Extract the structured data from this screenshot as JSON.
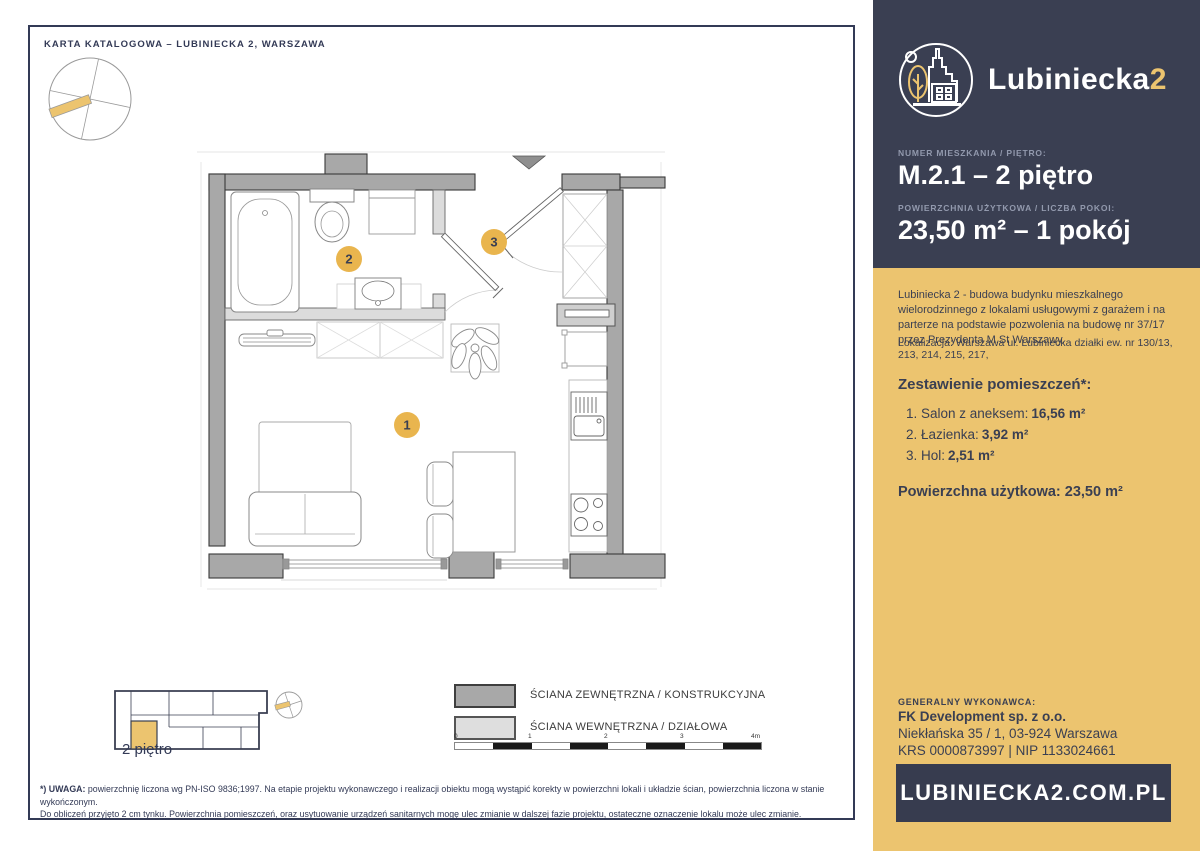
{
  "colors": {
    "navy": "#3a3f52",
    "panel_yellow": "#ecc46f",
    "badge_yellow": "#e9b54e",
    "wall_dark": "#a8a8a8",
    "wall_light": "#dcdcdc"
  },
  "card": {
    "header": "KARTA KATALOGOWA – LUBINIECKA 2, WARSZAWA",
    "mini_plan_label": "2 piętro",
    "plan_badges": {
      "salon": "1",
      "bathroom": "2",
      "hall": "3"
    },
    "legend": [
      {
        "label": "ŚCIANA ZEWNĘTRZNA / KONSTRUKCYJNA"
      },
      {
        "label": "ŚCIANA WEWNĘTRZNA / DZIAŁOWA"
      }
    ],
    "scale_ticks": [
      "0",
      "1",
      "2",
      "3",
      "4m"
    ],
    "footnote_label": "*) UWAGA:",
    "footnote_line1": "powierzchnię liczona wg PN-ISO 9836;1997. Na etapie projektu wykonawczego i realizacji obiektu mogą wystąpić korekty w powierzchni lokali i układzie ścian, powierzchnia liczona w stanie wykończonym.",
    "footnote_line2": "Do obliczeń przyjęto 2 cm tynku. Powierzchnia pomieszczeń, oraz usytuowanie urządzeń sanitarnych mogę ulec zmianie w dalszej fazie projektu, ostateczne oznaczenie lokalu może ulec zmianie."
  },
  "sidebar": {
    "logo_text": "Lubiniecka",
    "logo_accent": "2",
    "unit_label": "NUMER MIESZKANIA / PIĘTRO:",
    "unit_value": "M.2.1 – 2 piętro",
    "area_label": "POWIERZCHNIA UŻYTKOWA / LICZBA POKOI:",
    "area_value": "23,50 m² – 1 pokój",
    "description": "Lubiniecka 2 - budowa budynku mieszkalnego wielorodzinnego z lokalami usługowymi z garażem i na parterze na podstawie pozwolenia na budowę nr 37/17 przez Prezydenta M.St Warszawy.",
    "location": "Lokalizacja: Warszawa ul. Lubiniecka działki ew. nr 130/13, 213, 214, 215, 217,",
    "rooms_heading": "Zestawienie pomieszczeń*:",
    "rooms": [
      {
        "name": "1. Salon z aneksem:",
        "area": "16,56 m²"
      },
      {
        "name": "2. Łazienka:",
        "area": "3,92 m²"
      },
      {
        "name": "3. Hol:",
        "area": "2,51 m²"
      }
    ],
    "total_label": "Powierzchna użytkowa:",
    "total_value": "23,50 m²",
    "contractor_label": "GENERALNY WYKONAWCA:",
    "contractor_name": "FK Development sp. z o.o.",
    "contractor_address": "Niekłańska 35 / 1, 03-924 Warszawa",
    "contractor_ids": "KRS 0000873997 | NIP 1133024661",
    "website": "LUBINIECKA2.COM.PL"
  }
}
